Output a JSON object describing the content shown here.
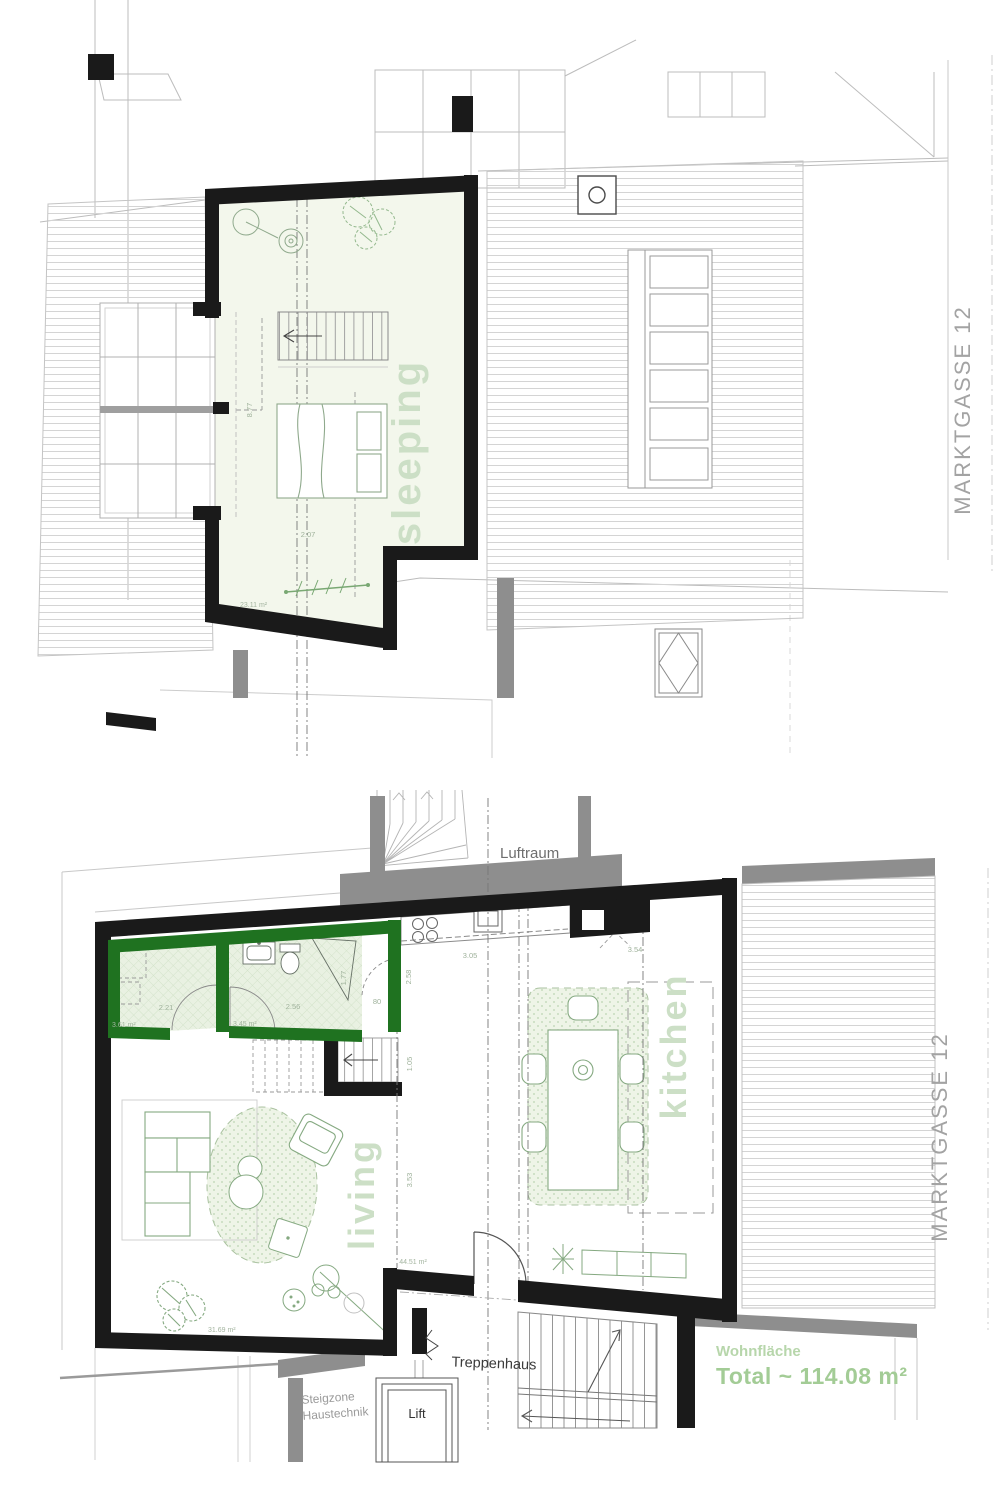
{
  "sheet": {
    "street_label": "MARKTGASSE 12"
  },
  "colors": {
    "wall_black": "#1a1a1a",
    "wall_gray": "#8e8e8e",
    "wall_green": "#1f7220",
    "label_green": "#ccdfc6",
    "summary_green": "#a3cc96"
  },
  "upper_plan": {
    "room": {
      "label": "sleeping",
      "area": "23.11 m²",
      "dim_width": "2.07",
      "dim_length": "8.77"
    }
  },
  "lower_plan": {
    "void_label": "Luftraum",
    "kitchen": {
      "label": "kitchen",
      "area": "44.51 m²",
      "dim_counter": "3.05",
      "dim_right": "3.54",
      "dim_corridor": "2.58"
    },
    "living": {
      "label": "living",
      "area": "31.69 m²",
      "dim_width": "3.53",
      "dim_hall": "1.05"
    },
    "bath": {
      "area": "3.45 m²",
      "dim_width": "2.56",
      "dim_shower": "1.77",
      "dim_door": "80"
    },
    "reduit": {
      "area": "3.61 m²",
      "dim_width": "2.21"
    },
    "stairwell_label": "Treppenhaus",
    "lift_label": "Lift",
    "riser_zone": {
      "line1": "Steigzone",
      "line2": "Haustechnik"
    },
    "summary": {
      "title": "Wohnfläche",
      "total": "Total  ~ 114.08 m²"
    }
  }
}
